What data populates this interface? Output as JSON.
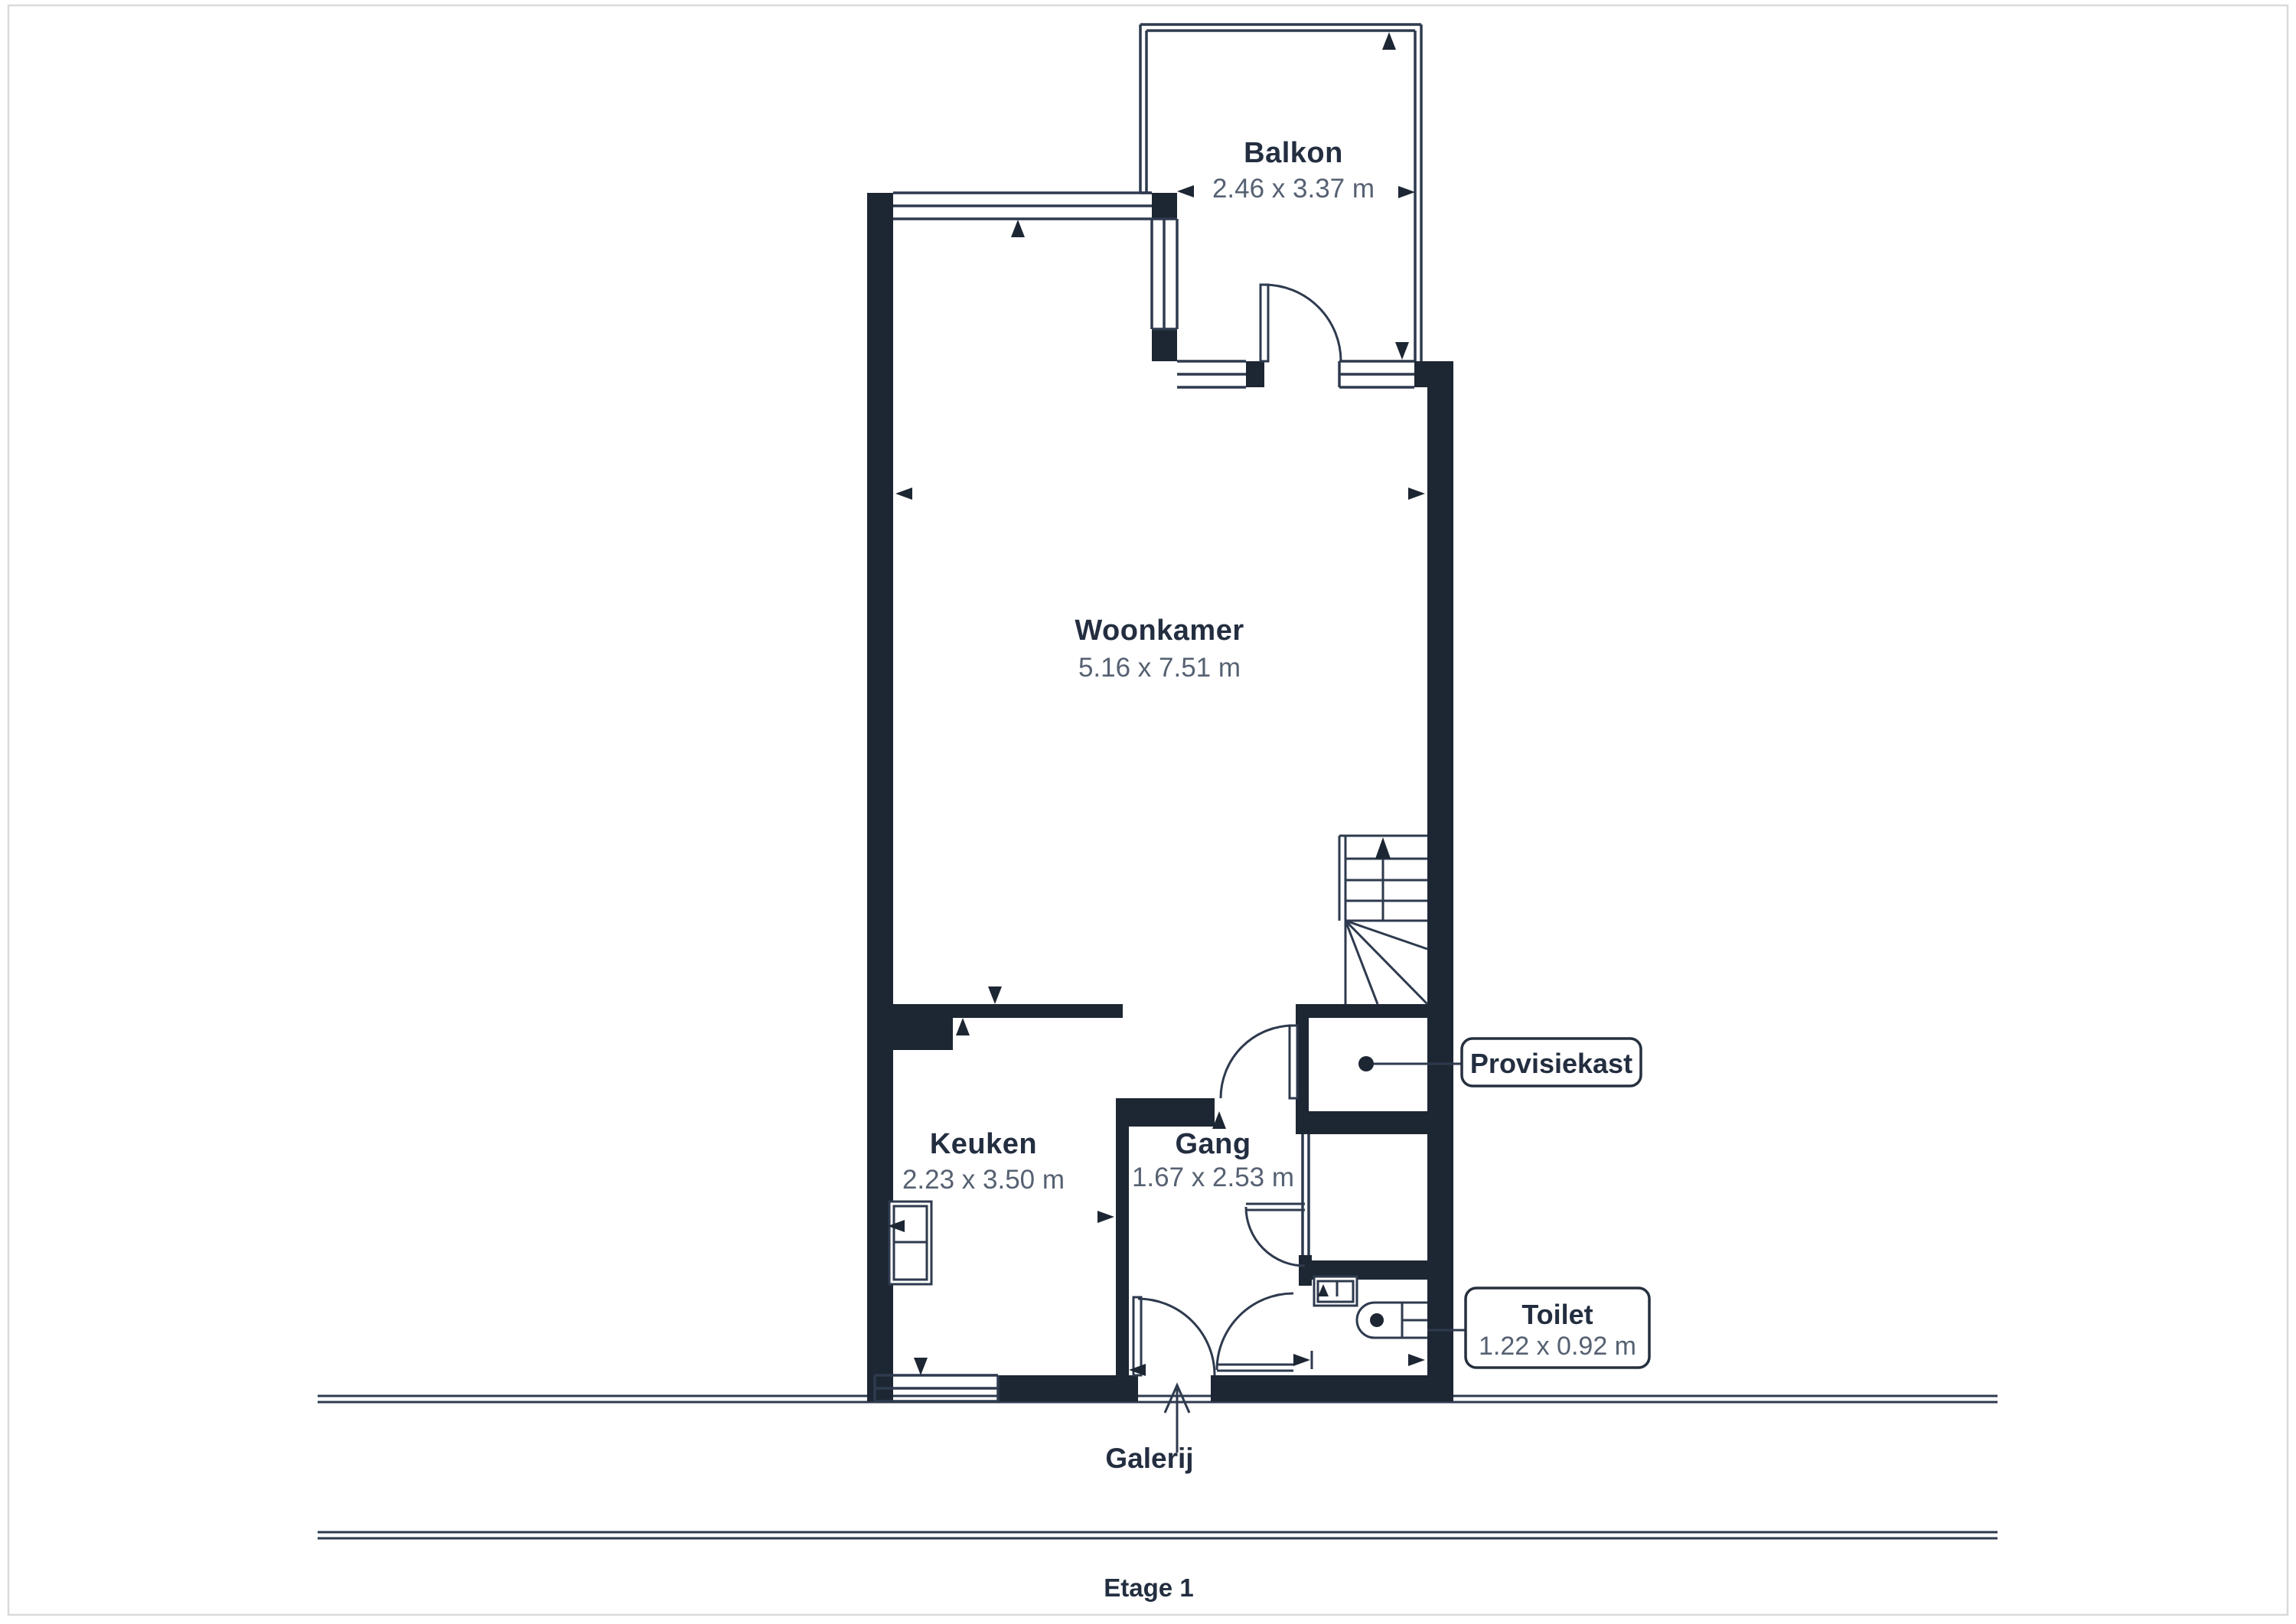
{
  "floorplan": {
    "floor_label": "Etage 1",
    "outdoor_label": "Galerij",
    "rooms": {
      "balkon": {
        "name": "Balkon",
        "dims": "2.46 x 3.37 m"
      },
      "woonkamer": {
        "name": "Woonkamer",
        "dims": "5.16 x 7.51 m"
      },
      "keuken": {
        "name": "Keuken",
        "dims": "2.23 x 3.50 m"
      },
      "gang": {
        "name": "Gang",
        "dims": "1.67 x 2.53 m"
      }
    },
    "callouts": {
      "provisiekast": {
        "label": "Provisiekast"
      },
      "toilet": {
        "label": "Toilet",
        "dims": "1.22 x 0.92 m"
      }
    },
    "colors": {
      "wall": "#1d2633",
      "thin_line": "#2e3a4e",
      "room_text": "#232e40",
      "dims_text": "#566172",
      "page_border": "#d9dadc"
    }
  }
}
